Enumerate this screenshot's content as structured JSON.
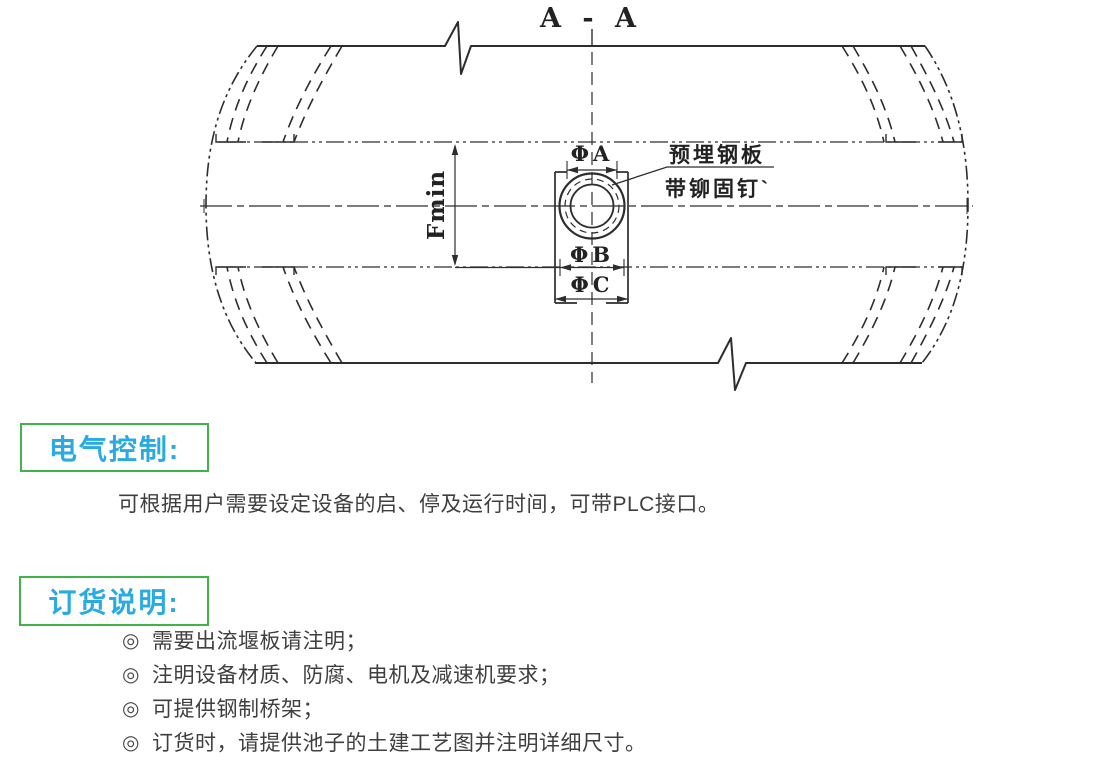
{
  "colors": {
    "heading_text": "#29ABE2",
    "heading_border": "#3FB549",
    "body_text": "#3F3F3F",
    "drawing_ink": "#2D2D2D"
  },
  "drawing": {
    "view_label": "A - A",
    "dims": {
      "a": "ΦA",
      "b": "ΦB",
      "c": "ΦC",
      "f": "Fmin"
    },
    "callout": {
      "line1": "预埋钢板",
      "line2": "带铆固钉`"
    }
  },
  "electrical": {
    "title": "电气控制:",
    "body": "可根据用户需要设定设备的启、停及运行时间，可带PLC接口。"
  },
  "ordering": {
    "title": "订货说明:",
    "marker": "◎",
    "items": [
      "需要出流堰板请注明；",
      "注明设备材质、防腐、电机及减速机要求；",
      "可提供钢制桥架；",
      "订货时，请提供池子的土建工艺图并注明详细尺寸。"
    ]
  }
}
